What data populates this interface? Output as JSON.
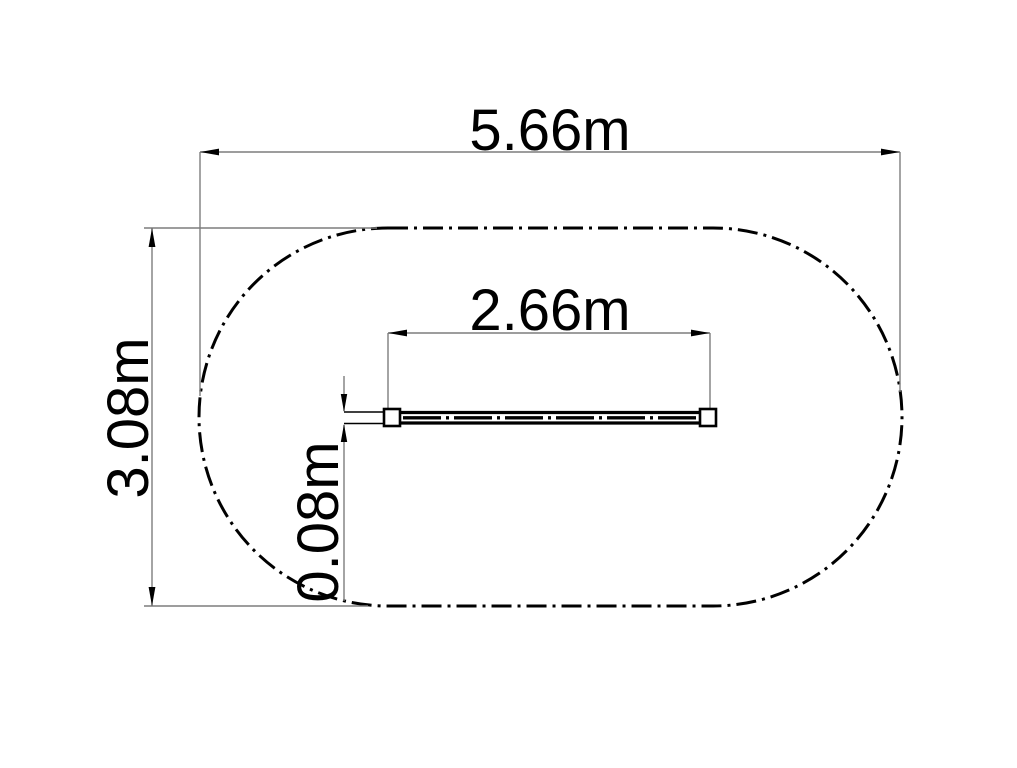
{
  "drawing": {
    "kind": "technical-plan-drawing",
    "background_color": "#ffffff",
    "ink_color": "#000000",
    "construction_line_color": "#7d7d7d",
    "safety_zone_outline_style": "dash-dot",
    "dimensions": {
      "overall_width": "5.66m",
      "overall_height": "3.08m",
      "equipment_length": "2.66m",
      "equipment_thickness": "0.08m"
    }
  }
}
